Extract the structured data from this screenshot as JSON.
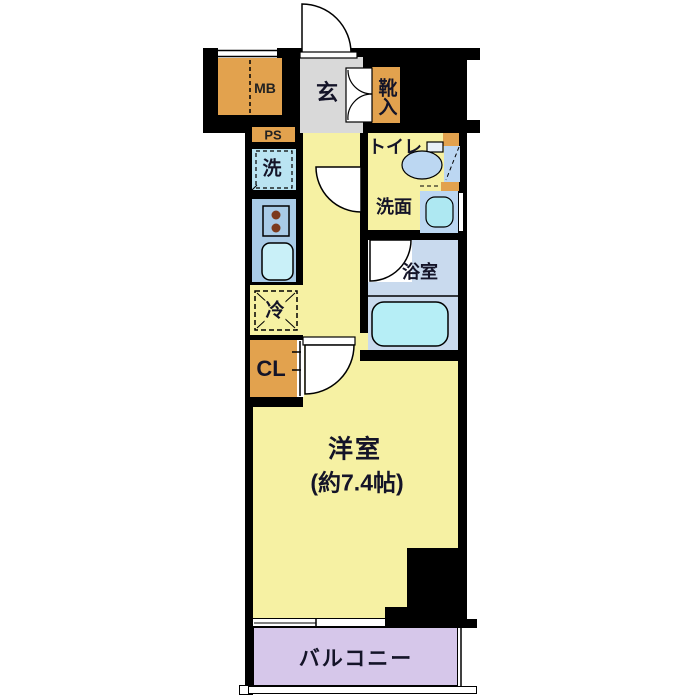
{
  "floorplan": {
    "rooms": {
      "entrance": {
        "label": "玄"
      },
      "shoe_cabinet": {
        "label": "靴入"
      },
      "meter_box": {
        "label": "MB"
      },
      "pipe_space": {
        "label": "PS"
      },
      "washer_space": {
        "label": "洗"
      },
      "toilet": {
        "label": "トイレ"
      },
      "washroom": {
        "label": "洗面"
      },
      "bathroom": {
        "label": "浴室"
      },
      "refrigerator_space": {
        "label": "冷"
      },
      "closet": {
        "label": "CL"
      },
      "western_room": {
        "label": "洋室",
        "size_label": "(約7.4帖)"
      },
      "balcony": {
        "label": "バルコニー"
      }
    },
    "colors": {
      "wall": "#000000",
      "room_yellow": "#F6F1A3",
      "fixture_orange": "#E2A24E",
      "entrance_gray": "#D9D9D9",
      "counter_blue": "#A9CBE7",
      "water_cyan": "#B6EEF6",
      "bathroom_blue": "#C9DAEE",
      "fixture_blue": "#BCD7F2",
      "balcony_purple": "#D6C7EA"
    }
  }
}
